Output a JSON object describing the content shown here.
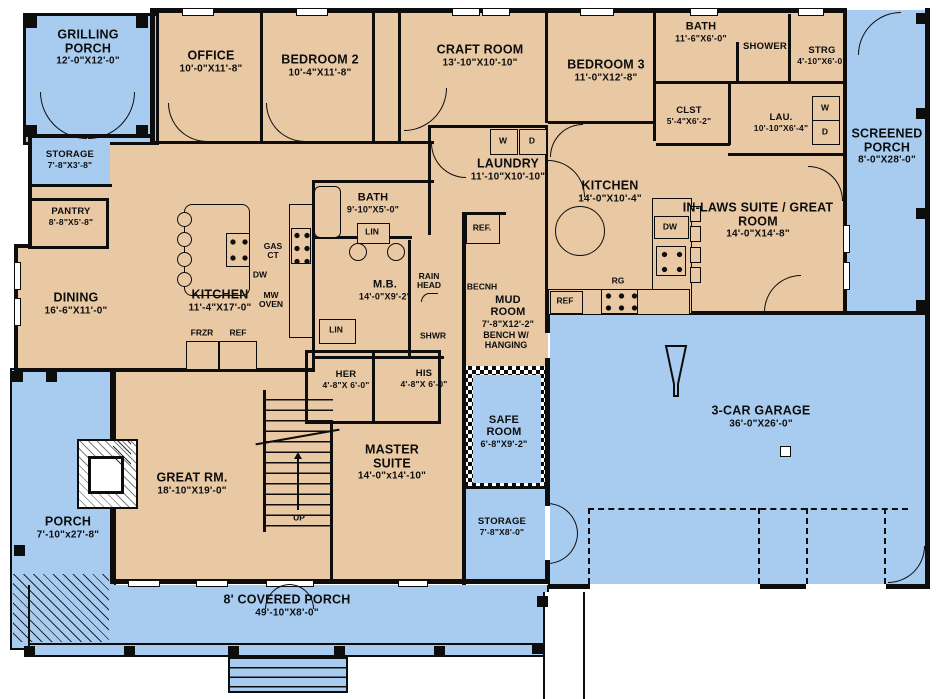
{
  "meta": {
    "type": "architectural-floor-plan",
    "floors_shown": 1
  },
  "colors": {
    "interior_fill": "#e9c9a4",
    "outdoor_fill": "#a8ccf0",
    "wall": "#0d0d0d",
    "background": "#ffffff"
  },
  "rooms": [
    {
      "id": "grilling-porch",
      "name": "GRILLING PORCH",
      "dims": "12'-0\"X12'-0\"",
      "area": "outdoor"
    },
    {
      "id": "office",
      "name": "OFFICE",
      "dims": "10'-0\"X11'-8\"",
      "area": "interior"
    },
    {
      "id": "bedroom-2",
      "name": "BEDROOM 2",
      "dims": "10'-4\"X11'-8\"",
      "area": "interior"
    },
    {
      "id": "craft-room",
      "name": "CRAFT ROOM",
      "dims": "13'-10\"X10'-10\"",
      "area": "interior"
    },
    {
      "id": "bedroom-3",
      "name": "BEDROOM 3",
      "dims": "11'-0\"X12'-8\"",
      "area": "interior"
    },
    {
      "id": "bath-top",
      "name": "BATH",
      "dims": "11'-6\"X6'-0\"",
      "area": "interior"
    },
    {
      "id": "shower",
      "name": "SHOWER",
      "dims": "",
      "area": "interior"
    },
    {
      "id": "strg",
      "name": "STRG",
      "dims": "4'-10\"X6'-0\"",
      "area": "interior"
    },
    {
      "id": "screened-porch",
      "name": "SCREENED PORCH",
      "dims": "8'-0\"X28'-0\"",
      "area": "outdoor"
    },
    {
      "id": "storage-top",
      "name": "STORAGE",
      "dims": "7'-8\"X3'-8\"",
      "area": "outdoor"
    },
    {
      "id": "pantry",
      "name": "PANTRY",
      "dims": "8'-8\"X5'-8\"",
      "area": "interior"
    },
    {
      "id": "clst",
      "name": "CLST",
      "dims": "5'-4\"X6'-2\"",
      "area": "interior"
    },
    {
      "id": "lau",
      "name": "LAU.",
      "dims": "10'-10\"X6'-4\"",
      "area": "interior"
    },
    {
      "id": "laundry",
      "name": "LAUNDRY",
      "dims": "11'-10\"X10'-10\"",
      "area": "interior"
    },
    {
      "id": "dining",
      "name": "DINING",
      "dims": "16'-6\"X11'-0\"",
      "area": "interior"
    },
    {
      "id": "kitchen",
      "name": "KITCHEN",
      "dims": "11'-4\"X17'-0\"",
      "area": "interior"
    },
    {
      "id": "bath-central",
      "name": "BATH",
      "dims": "9'-10\"X5'-0\"",
      "area": "interior"
    },
    {
      "id": "master-bath",
      "name": "M.B.",
      "dims": "14'-0\"X9'-2\"",
      "area": "interior"
    },
    {
      "id": "kitchen-inlaws",
      "name": "KITCHEN",
      "dims": "14'-0\"X10'-4\"",
      "area": "interior"
    },
    {
      "id": "inlaws-suite",
      "name": "IN-LAWS SUITE / GREAT ROOM",
      "dims": "14'-0\"X14'-8\"",
      "area": "interior"
    },
    {
      "id": "mud-room",
      "name": "MUD ROOM",
      "dims": "7'-8\"X12'-2\"",
      "note": "BENCH W/ HANGING",
      "area": "interior"
    },
    {
      "id": "her-closet",
      "name": "HER",
      "dims": "4'-8\"X 6'-0\"",
      "area": "interior"
    },
    {
      "id": "his-closet",
      "name": "HIS",
      "dims": "4'-8\"X 6'-0\"",
      "area": "interior"
    },
    {
      "id": "safe-room",
      "name": "SAFE ROOM",
      "dims": "6'-8\"X9'-2\"",
      "area": "outdoor"
    },
    {
      "id": "great-rm",
      "name": "GREAT RM.",
      "dims": "18'-10\"X19'-0\"",
      "area": "interior"
    },
    {
      "id": "master-suite",
      "name": "MASTER SUITE",
      "dims": "14'-0\"x14'-10\"",
      "area": "interior"
    },
    {
      "id": "storage-bottom",
      "name": "STORAGE",
      "dims": "7'-8\"X8'-0\"",
      "area": "outdoor"
    },
    {
      "id": "garage",
      "name": "3-CAR GARAGE",
      "dims": "36'-0\"X26'-0\"",
      "area": "outdoor"
    },
    {
      "id": "porch",
      "name": "PORCH",
      "dims": "7'-10\"x27'-8\"",
      "area": "outdoor"
    },
    {
      "id": "covered-porch",
      "name": "8' COVERED PORCH",
      "dims": "49'-10\"X8'-0\"",
      "area": "outdoor"
    }
  ],
  "fixtures": {
    "washer": "W",
    "dryer": "D",
    "ref_dot": "REF.",
    "ref": "REF",
    "frzr": "FRZR",
    "dw": "DW",
    "gas_ct": "GAS CT",
    "mw_oven": "MW OVEN",
    "rg": "RG",
    "lin": "LIN",
    "shwr": "SHWR",
    "rain_head": "RAIN HEAD",
    "bench": "BECNH",
    "up": "UP"
  }
}
